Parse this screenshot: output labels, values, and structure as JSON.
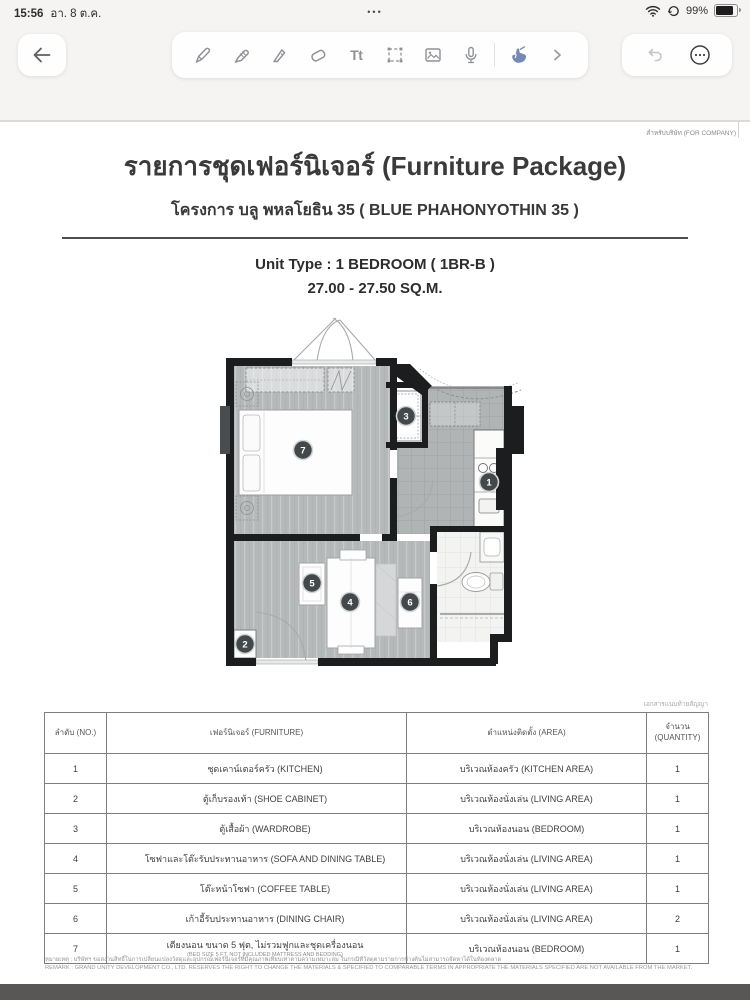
{
  "status_bar": {
    "time": "15:56",
    "date": "อา. 8 ต.ค.",
    "multitask_dots": "•••",
    "battery_percent": "99%"
  },
  "toolbar": {
    "text_tool_label": "Tt",
    "tools": [
      "pencil",
      "marker",
      "ballpoint-pen",
      "eraser",
      "text",
      "lasso",
      "image",
      "microphone",
      "hand-pointer",
      "more-tools"
    ],
    "accent_hand_color": "#7589b2"
  },
  "document": {
    "corner_note": "สำหรับบริษัท (FOR COMPANY)",
    "title": "รายการชุดเฟอร์นิเจอร์ (Furniture Package)",
    "subtitle": "โครงการ บลู พหลโยธิน 35  ( BLUE PHAHONYOTHIN 35 )",
    "unit_type": "Unit Type : 1 BEDROOM ( 1BR-B )",
    "unit_area": "27.00 - 27.50 SQ.M.",
    "table_note": "เอกสารแนบท้ายสัญญา",
    "table": {
      "headers": [
        "ลำดับ (NO.)",
        "เฟอร์นิเจอร์ (FURNITURE)",
        "ตำแหน่งติดตั้ง (AREA)",
        "จำนวน (QUANTITY)"
      ],
      "rows": [
        {
          "no": "1",
          "furniture": "ชุดเคาน์เตอร์ครัว (KITCHEN)",
          "area": "บริเวณห้องครัว (KITCHEN AREA)",
          "qty": "1"
        },
        {
          "no": "2",
          "furniture": "ตู้เก็บรองเท้า (SHOE CABINET)",
          "area": "บริเวณห้องนั่งเล่น (LIVING AREA)",
          "qty": "1"
        },
        {
          "no": "3",
          "furniture": "ตู้เสื้อผ้า (WARDROBE)",
          "area": "บริเวณห้องนอน (BEDROOM)",
          "qty": "1"
        },
        {
          "no": "4",
          "furniture": "โซฟาและโต๊ะรับประทานอาหาร (SOFA AND DINING TABLE)",
          "area": "บริเวณห้องนั่งเล่น (LIVING AREA)",
          "qty": "1"
        },
        {
          "no": "5",
          "furniture": "โต๊ะหน้าโซฟา (COFFEE TABLE)",
          "area": "บริเวณห้องนั่งเล่น (LIVING AREA)",
          "qty": "1"
        },
        {
          "no": "6",
          "furniture": "เก้าอี้รับประทานอาหาร (DINING CHAIR)",
          "area": "บริเวณห้องนั่งเล่น (LIVING AREA)",
          "qty": "2"
        },
        {
          "no": "7",
          "furniture": "เตียงนอน ขนาด 5 ฟุต, ไม่รวมฟูกและชุดเครื่องนอน",
          "furniture_sub": "(BED SIZE 5 FT. NOT INCLUDED MATTRESS AND BEDDING)",
          "area": "บริเวณห้องนอน (BEDROOM)",
          "qty": "1"
        }
      ]
    },
    "remark_th": "หมายเหตุ : บริษัทฯ ขอสงวนสิทธิ์ในการเปลี่ยนแปลงวัสดุและอุปกรณ์เฟอร์นิเจอร์ที่มีคุณภาพเทียบเท่าตามความเหมาะสม ในกรณีที่วัสดุตามรายการข้างต้นไม่สามารถจัดหาได้ในท้องตลาด",
    "remark_en": "REMARK : GRAND UNITY DEVELOPMENT CO., LTD. RESERVES THE RIGHT TO CHANGE THE MATERIALS & SPECIFIED TO COMPARABLE TERMS IN APPROPRIATE THE MATERIALS SPECIFIED ARE NOT AVAILABLE FROM THE MARKET."
  },
  "floorplan": {
    "markers": [
      {
        "n": "1",
        "item": "kitchen-counter"
      },
      {
        "n": "2",
        "item": "shoe-cabinet"
      },
      {
        "n": "3",
        "item": "wardrobe"
      },
      {
        "n": "4",
        "item": "sofa-dining-table"
      },
      {
        "n": "5",
        "item": "coffee-table"
      },
      {
        "n": "6",
        "item": "dining-chair"
      },
      {
        "n": "7",
        "item": "bed"
      }
    ]
  },
  "colors": {
    "wall": "#1b1d1e",
    "wood_floor": "#b6b9ba",
    "tile_floor": "#b1b4b5",
    "chrome_bg": "#f5f4f2",
    "bottom_bar": "#585756",
    "hand_tool_blue": "#7589b2"
  }
}
